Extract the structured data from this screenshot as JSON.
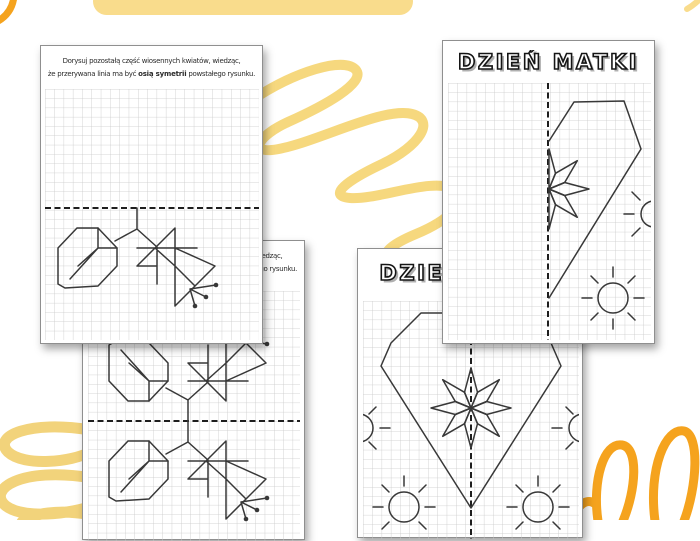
{
  "banner": {
    "color": "#f9dc8c"
  },
  "decorations": {
    "scribble_light_yellow": "#f6d87e",
    "scribble_orange": "#f5a31e"
  },
  "worksheets": {
    "top_left": {
      "line1": "Dorysuj pozostałą część wiosennych kwiatów, wiedząc,",
      "line2_a": "że przerywana linia ma być ",
      "line2_bold": "osią symetrii",
      "line2_b": " powstałego rysunku."
    },
    "top_right": {
      "title": "DZIEŃ MATKI"
    },
    "bottom_left": {
      "line1": "Dorysuj pozostałą część wiosennych kwiatów, wiedząc,",
      "line2_a": "że przerywana linia ma być ",
      "line2_bold": "osią symetrii",
      "line2_b": " powstałego rysunku."
    },
    "bottom_right": {
      "title": "DZIEŃ MATKI"
    }
  }
}
